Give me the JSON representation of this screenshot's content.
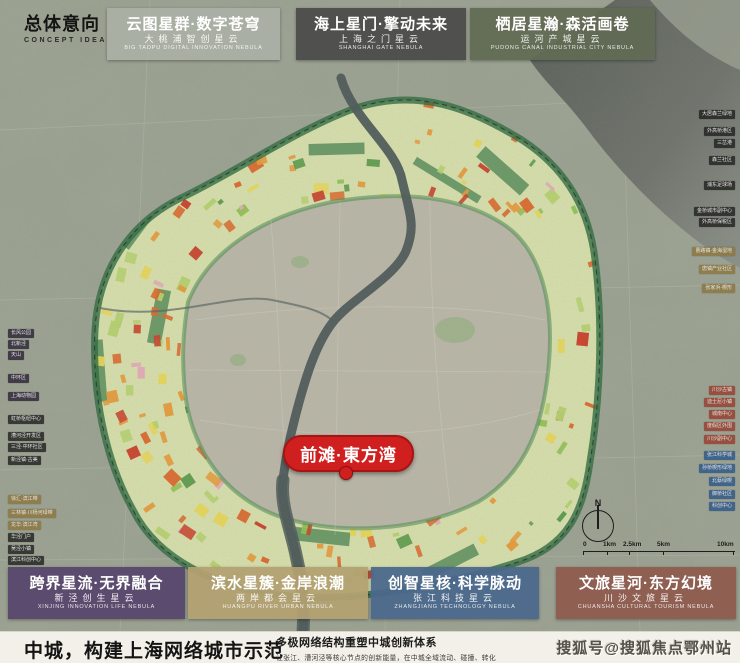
{
  "header": {
    "concept_title": "总体意向",
    "concept_subtitle": "CONCEPT IDEA"
  },
  "nebula_labels": {
    "top": [
      {
        "zh": "云图星群·数字苍穹",
        "sub_zh": "大桃浦智创星云",
        "sub_en": "BIG TAOPU DIGITAL INNOVATION NEBULA",
        "bg": "rgba(175,180,170,0.72)"
      },
      {
        "zh": "海上星门·擎动未来",
        "sub_zh": "上海之门星云",
        "sub_en": "SHANGHAI GATE NEBULA",
        "bg": "rgba(74,74,74,0.92)"
      },
      {
        "zh": "栖居星瀚·森活画卷",
        "sub_zh": "运河产城星云",
        "sub_en": "PUDONG CANAL INDUSTRIAL CITY NEBULA",
        "bg": "rgba(97,106,84,0.92)"
      }
    ],
    "bottom": [
      {
        "zh": "跨界星流·无界融合",
        "sub_zh": "新泾创生星云",
        "sub_en": "XINJING INNOVATION LIFE NEBULA",
        "bg": "rgba(87,69,107,0.94)"
      },
      {
        "zh": "滨水星簇·金岸浪潮",
        "sub_zh": "两岸都会星云",
        "sub_en": "HUANGPU RIVER URBAN NEBULA",
        "bg": "rgba(178,160,113,0.94)"
      },
      {
        "zh": "创智星核·科学脉动",
        "sub_zh": "张江科技星云",
        "sub_en": "ZHANGJIANG TECHNOLOGY NEBULA",
        "bg": "rgba(74,104,140,0.94)"
      },
      {
        "zh": "文旅星河·东方幻境",
        "sub_zh": "川沙文旅星云",
        "sub_en": "CHUANSHA CULTURAL TOURISM NEBULA",
        "bg": "rgba(142,90,78,0.94)"
      }
    ]
  },
  "map": {
    "marker": {
      "label": "前滩·東方湾"
    },
    "compass": {
      "letter": "N"
    },
    "scale_bar": {
      "ticks": [
        "0",
        "1km",
        "2.5km",
        "5km",
        "10km"
      ]
    },
    "side_labels": {
      "styles": {
        "purple": "rgba(52,44,62,0.88)",
        "dark": "rgba(36,37,36,0.84)",
        "tan": "rgba(141,122,72,0.92)",
        "brick": "rgba(152,72,56,0.92)",
        "blue": "rgba(58,94,138,0.92)"
      },
      "left": [
        {
          "text": "长风公园",
          "y": 329,
          "group": "purple"
        },
        {
          "text": "北新泾",
          "y": 340,
          "group": "purple"
        },
        {
          "text": "天山",
          "y": 351,
          "group": "purple"
        },
        {
          "text": "中环区",
          "y": 374,
          "group": "purple"
        },
        {
          "text": "上海动物园",
          "y": 392,
          "group": "purple"
        },
        {
          "text": "虹桥枢纽中心",
          "y": 415,
          "group": "dark"
        },
        {
          "text": "漕河泾开发区",
          "y": 432,
          "group": "dark"
        },
        {
          "text": "三泾·中环社区",
          "y": 443,
          "group": "dark"
        },
        {
          "text": "新泾镇·古美",
          "y": 456,
          "group": "dark"
        },
        {
          "text": "徐汇·滨江带",
          "y": 495,
          "group": "tan"
        },
        {
          "text": "三林镇·川杨河绿带",
          "y": 509,
          "group": "tan"
        },
        {
          "text": "龙华·滨江湾",
          "y": 521,
          "group": "tan"
        },
        {
          "text": "华泾门户",
          "y": 533,
          "group": "dark"
        },
        {
          "text": "吴泾小镇",
          "y": 545,
          "group": "dark"
        },
        {
          "text": "滨江科创中心",
          "y": 556,
          "group": "dark"
        }
      ],
      "right": [
        {
          "text": "大居森兰绿地",
          "y": 110,
          "group": "dark"
        },
        {
          "text": "外高桥港区",
          "y": 127,
          "group": "dark"
        },
        {
          "text": "三岔港",
          "y": 139,
          "group": "dark"
        },
        {
          "text": "森兰社区",
          "y": 156,
          "group": "dark"
        },
        {
          "text": "浦东足球场",
          "y": 181,
          "group": "dark"
        },
        {
          "text": "金桥城市副中心",
          "y": 207,
          "group": "dark"
        },
        {
          "text": "外高桥保税区",
          "y": 218,
          "group": "dark"
        },
        {
          "text": "曹路镇·金海湿地",
          "y": 247,
          "group": "tan"
        },
        {
          "text": "唐镇产业社区",
          "y": 265,
          "group": "tan"
        },
        {
          "text": "张家浜·楔形",
          "y": 284,
          "group": "tan"
        },
        {
          "text": "川沙古镇",
          "y": 386,
          "group": "brick"
        },
        {
          "text": "迪士尼小镇",
          "y": 398,
          "group": "brick"
        },
        {
          "text": "城南中心",
          "y": 410,
          "group": "brick"
        },
        {
          "text": "度假区外围",
          "y": 422,
          "group": "brick"
        },
        {
          "text": "川沙副中心",
          "y": 435,
          "group": "brick"
        },
        {
          "text": "张江科学城",
          "y": 451,
          "group": "blue"
        },
        {
          "text": "孙桥楔形绿地",
          "y": 464,
          "group": "blue"
        },
        {
          "text": "北蔡绿楔",
          "y": 477,
          "group": "blue"
        },
        {
          "text": "御桥社区",
          "y": 490,
          "group": "blue"
        },
        {
          "text": "科创中心",
          "y": 502,
          "group": "blue"
        }
      ]
    }
  },
  "footer": {
    "headline": "中城，构建上海网络城市示范",
    "sub_headline": "多极网络结构重塑中城创新体系",
    "description": "让张江、漕河泾等核心节点的创新能量，在中城全域流动、碰撞、转化",
    "watermark": "搜狐号@搜狐焦点鄂州站"
  },
  "colors": {
    "marker_red": "#d01f1f",
    "ring_fill": "#dde4ae",
    "green_belt": "#2e6b3f",
    "river": "#4e5a58",
    "footer_bg": "#f3f0e9"
  }
}
